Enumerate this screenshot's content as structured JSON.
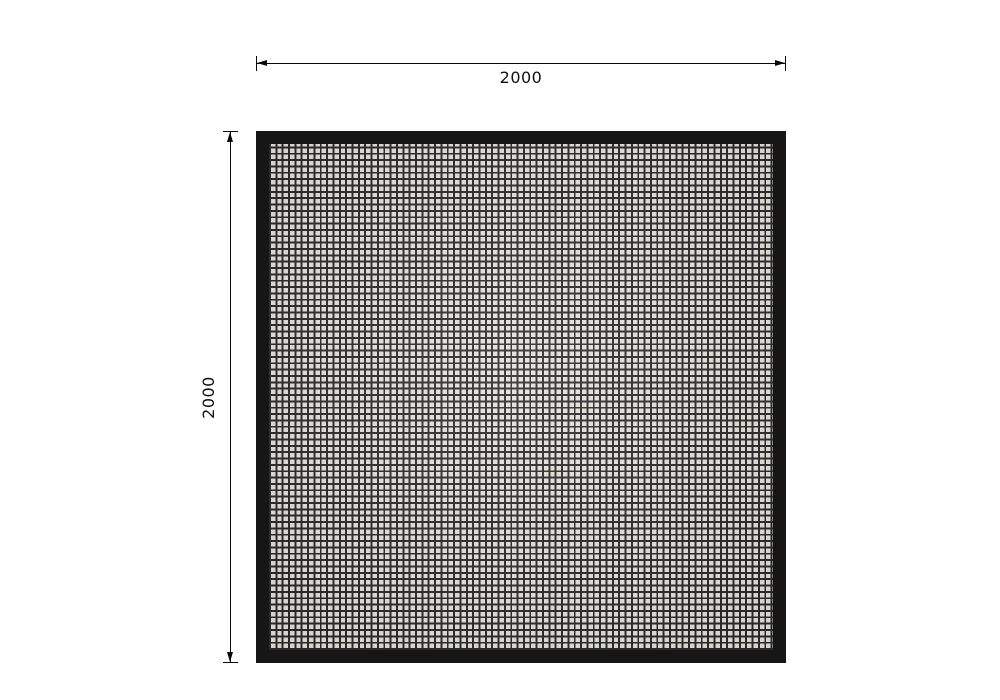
{
  "drawing": {
    "dimensions": {
      "width_label": "2000",
      "height_label": "2000"
    }
  },
  "colors": {
    "background": "#ffffff",
    "frame": "#161616",
    "mesh_cell": "#e4e1db",
    "mesh_line": "#2b2b2b",
    "dimension": "#0a0a0a"
  }
}
